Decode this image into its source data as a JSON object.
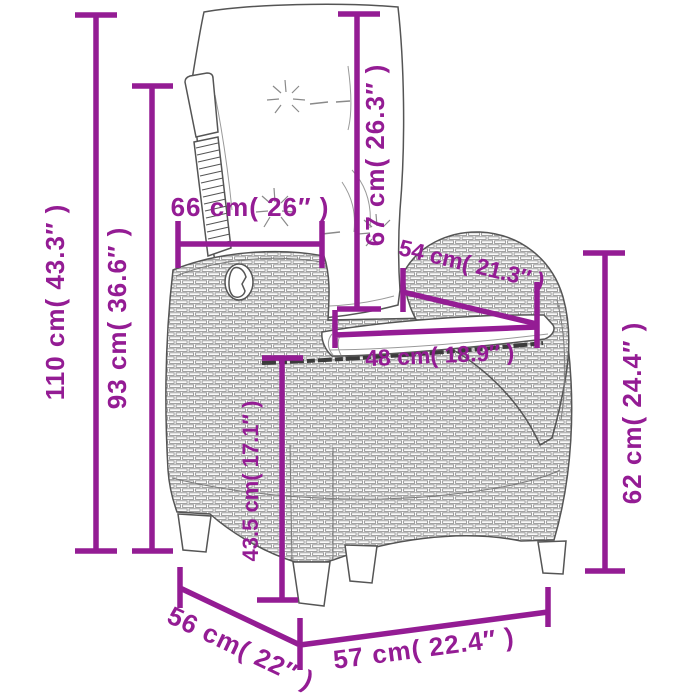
{
  "page": {
    "type": "product-dimension-diagram",
    "subject": "reclining rattan garden chair with back and seat cushion",
    "background": "#ffffff"
  },
  "style": {
    "dimension_color": "#941C94",
    "outline_color": "#555555",
    "texture_color": "#919191",
    "detail_color": "#888888",
    "seam_color": "#3b3b3b",
    "cushion_fill": "#ffffff"
  },
  "dimensions": {
    "dim_110": {
      "label": "110 cm( 43.3″ )"
    },
    "dim_93": {
      "label": "93 cm( 36.6″ )"
    },
    "dim_66": {
      "label": "66 cm( 26″ )"
    },
    "dim_67": {
      "label": "67 cm( 26.3″ )"
    },
    "dim_54": {
      "label": "54 cm( 21.3″ )"
    },
    "dim_48": {
      "label": "48 cm( 18.9″ )"
    },
    "dim_43_5": {
      "label": "43.5 cm( 17.1″ )"
    },
    "dim_62": {
      "label": "62 cm( 24.4″ )"
    },
    "dim_56": {
      "label": "56 cm( 22″ )"
    },
    "dim_57": {
      "label": "57 cm( 22.4″ )"
    }
  }
}
